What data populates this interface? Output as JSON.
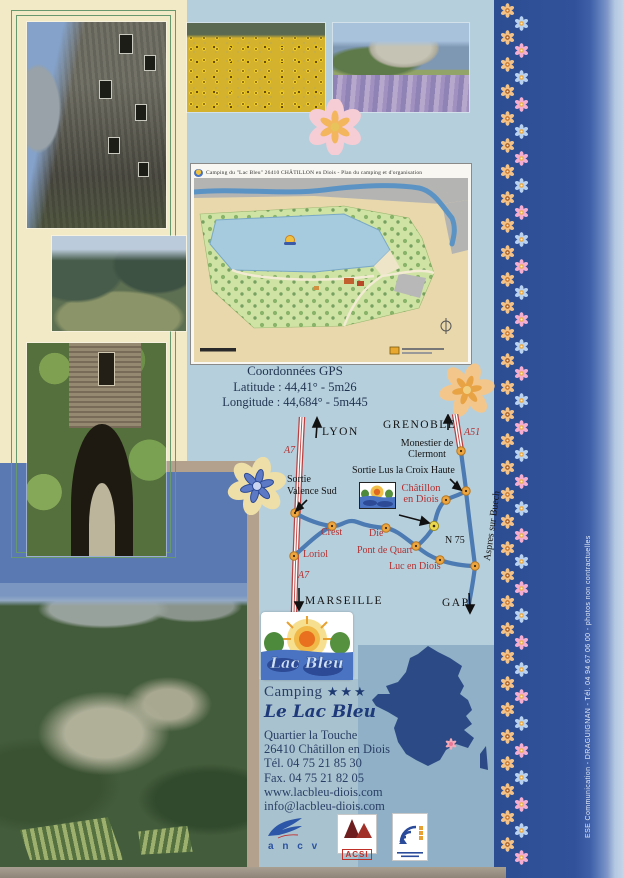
{
  "colors": {
    "page_bg": "#b6cfdc",
    "cream_panel": "#f2e9c6",
    "side_band": "#2f4f96",
    "slate_block": "#5a79b2",
    "road_red": "#b03838",
    "road_blue": "#4c7ab2",
    "label_red": "#b23030",
    "navy_text": "#22386a"
  },
  "campground_map": {
    "title": "Camping du \"Lac Bleu\"   26410 CHÂTILLON en Diois  -  Plan du camping et d'organisation"
  },
  "gps": {
    "title": "Coordonnées GPS",
    "latitude": "Latitude : 44,41° - 5m26",
    "longitude": "Longitude : 44,684° - 5m445"
  },
  "road_map": {
    "lyon": "LYON",
    "grenoble": "GRENOBLE",
    "marseille": "MARSEILLE",
    "gap": "GAP",
    "a7_top": "A7",
    "a7_bottom": "A7",
    "a51": "A51",
    "n75": "N 75",
    "monestier_line1": "Monestier de",
    "monestier_line2": "Clermont",
    "sortie_lus": "Sortie Lus la Croix Haute",
    "sortie_valence_line1": "Sortie",
    "sortie_valence_line2": "Valence Sud",
    "chatillon_line1": "Châtillon",
    "chatillon_line2": "en Diois",
    "crest": "Crest",
    "die": "Die",
    "loriol": "Loriol",
    "pont_de_quart": "Pont de Quart",
    "luc_en_diois": "Luc en Diois",
    "aspres": "Aspres sur Buech"
  },
  "logo": {
    "script": "Lac Bleu"
  },
  "info": {
    "type": "Camping",
    "stars": "★★★",
    "name": "Le Lac Bleu",
    "address_line1": "Quartier la Touche",
    "address_line2": "26410 Châtillon en Diois",
    "phone": "Tél. 04 75 21 85 30",
    "fax": "Fax. 04 75 21 82 05",
    "website": "www.lacbleu-diois.com",
    "email": "info@lacbleu-diois.com"
  },
  "partners": {
    "ancv": "a n c v",
    "acsi": "ACSI"
  },
  "credit": "ESE Communication - DRAGUIGNAN - Tél. 04 94 67 06 00 - photos non contractuelles"
}
